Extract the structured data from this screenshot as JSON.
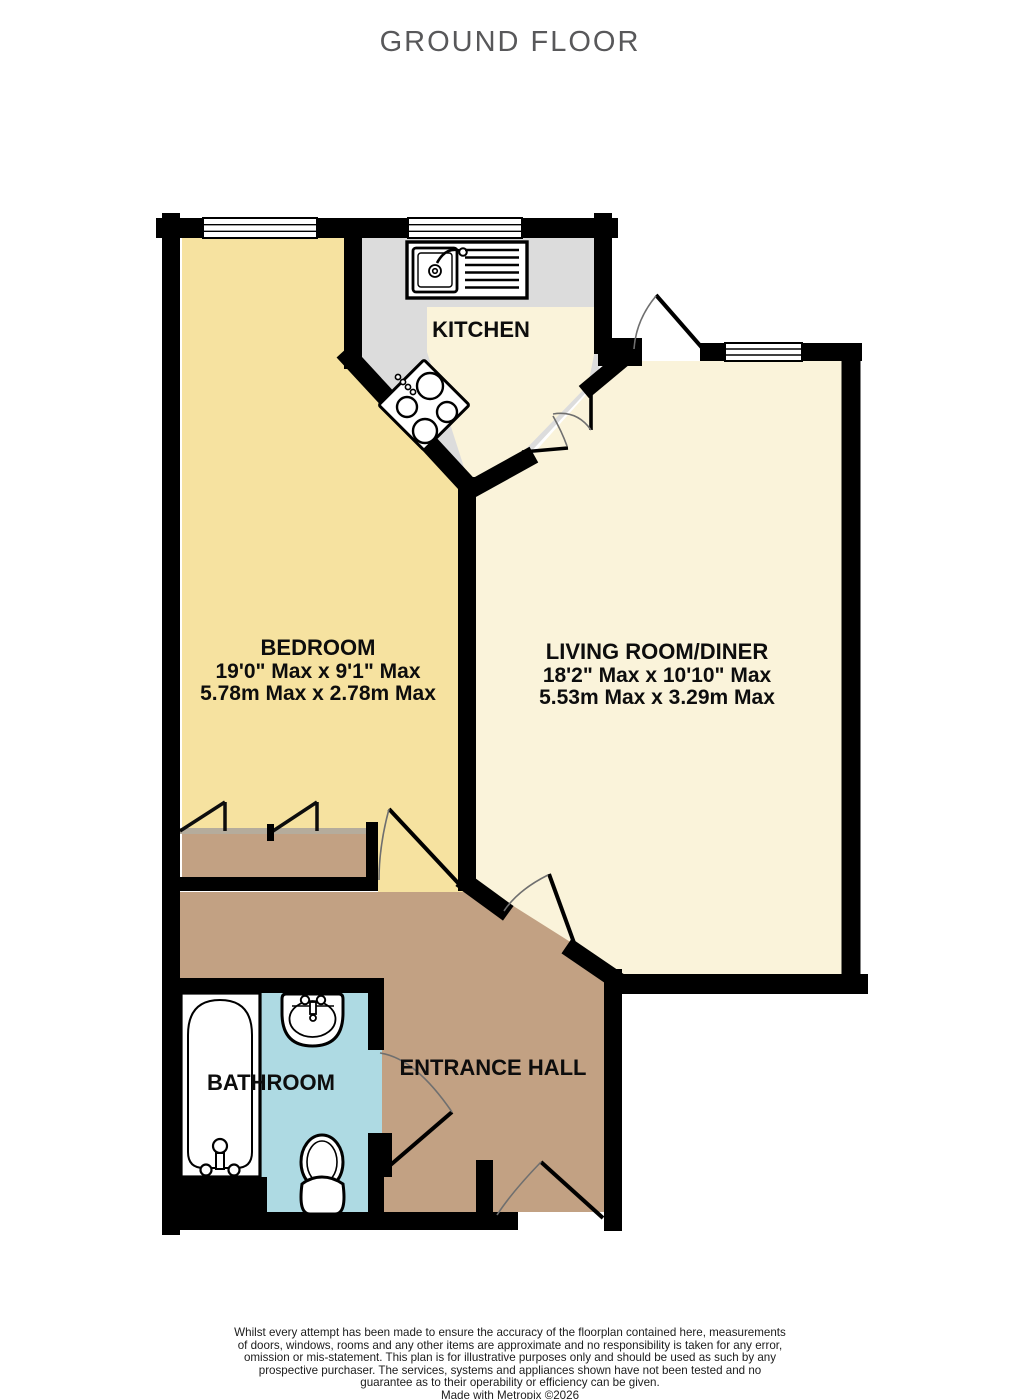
{
  "title": "GROUND FLOOR",
  "palette": {
    "wall": "#000000",
    "bedroom": "#f6e2a0",
    "living": "#faf3da",
    "kitchen_counter": "#dcdcdc",
    "kitchen_floor": "#faf3da",
    "hall": "#c2a183",
    "wardrobe": "#c2a183",
    "bathroom": "#aedae3",
    "window": "#ffffff"
  },
  "rooms": {
    "kitchen": {
      "label": "KITCHEN"
    },
    "bedroom": {
      "label": "BEDROOM",
      "dims_imperial": "19'0\" Max x 9'1\" Max",
      "dims_metric": "5.78m Max x 2.78m Max"
    },
    "living": {
      "label": "LIVING ROOM/DINER",
      "dims_imperial": "18'2\" Max x 10'10\" Max",
      "dims_metric": "5.53m Max x 3.29m Max"
    },
    "bathroom": {
      "label": "BATHROOM"
    },
    "hall": {
      "label": "ENTRANCE HALL"
    }
  },
  "footer": {
    "disclaimer": "Whilst every attempt has been made to ensure the accuracy of the floorplan contained here, measurements of doors, windows, rooms and any other items are approximate and no responsibility is taken for any error, omission or mis-statement. This plan is for illustrative purposes only and should be used as such by any prospective purchaser. The services, systems and appliances shown have not been tested and no guarantee as to their operability or efficiency can be given.",
    "credit": "Made with Metropix ©2026"
  }
}
